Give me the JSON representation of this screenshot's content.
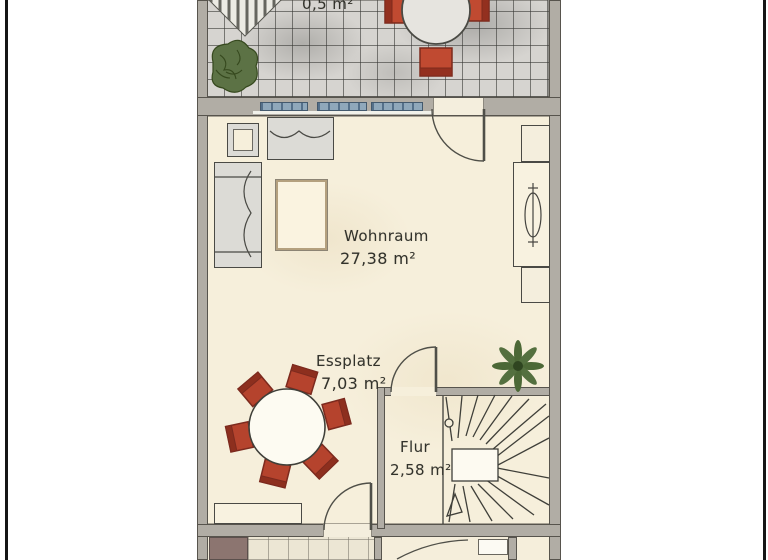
{
  "labels": {
    "terrace_area": "0,5 m²",
    "wohnraum": {
      "name": "Wohnraum",
      "area": "27,38 m²"
    },
    "essplatz": {
      "name": "Essplatz",
      "area": "7,03 m²"
    },
    "flur": {
      "name": "Flur",
      "area": "2,58 m²"
    }
  },
  "colors": {
    "floor": "#f6efdb",
    "terrace_tile": "#d6d4d0",
    "wall": "#b1ada5",
    "window_glass": "#8fa8bb",
    "furniture_red": "#b5432d",
    "plant_green": "#54703f",
    "ink": "#3a3a32",
    "page_edge": "#161616"
  }
}
